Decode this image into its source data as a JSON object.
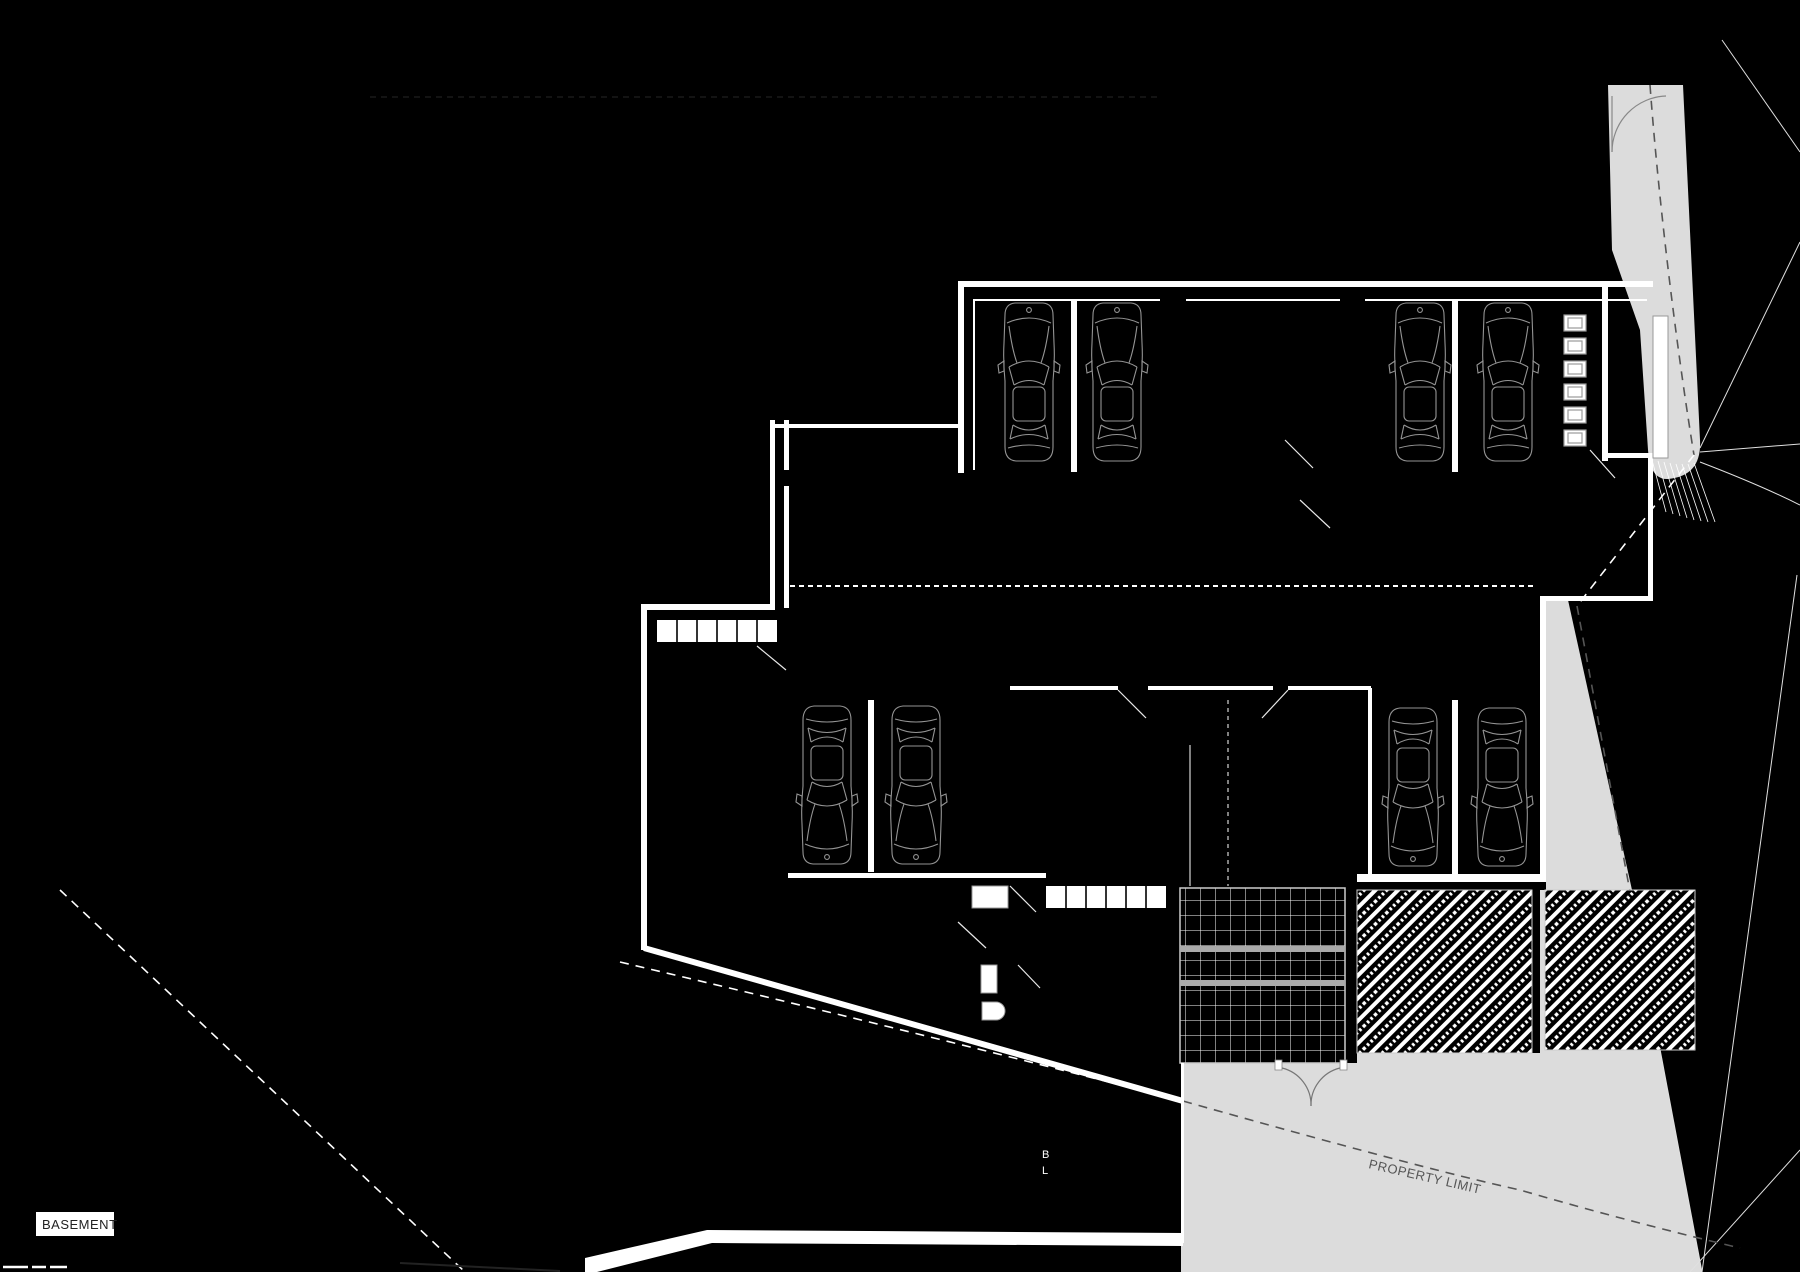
{
  "plan": {
    "floor_label": "BASEMENT",
    "property_limit_label": "PROPERTY LIMIT",
    "section_marker_top": "B",
    "section_marker_bottom": "L",
    "drawing_type": "basement parking floor plan",
    "colors": {
      "background": "#000000",
      "walls": "#ffffff",
      "terrain": "#dcdcdc",
      "car_outline": "#949494",
      "property_limit_text": "#555555",
      "label_text": "#222222"
    },
    "contents": {
      "cars_total": 8,
      "cars_upper_row": 4,
      "cars_lower_left": 2,
      "cars_lower_right": 2,
      "storage_lockers": 6,
      "stair_flights": 2,
      "stair_treads_per_flight": 6,
      "entrance_double_door": 1,
      "hatched_zones": 2,
      "tiled_ramp_zones": 1
    }
  }
}
